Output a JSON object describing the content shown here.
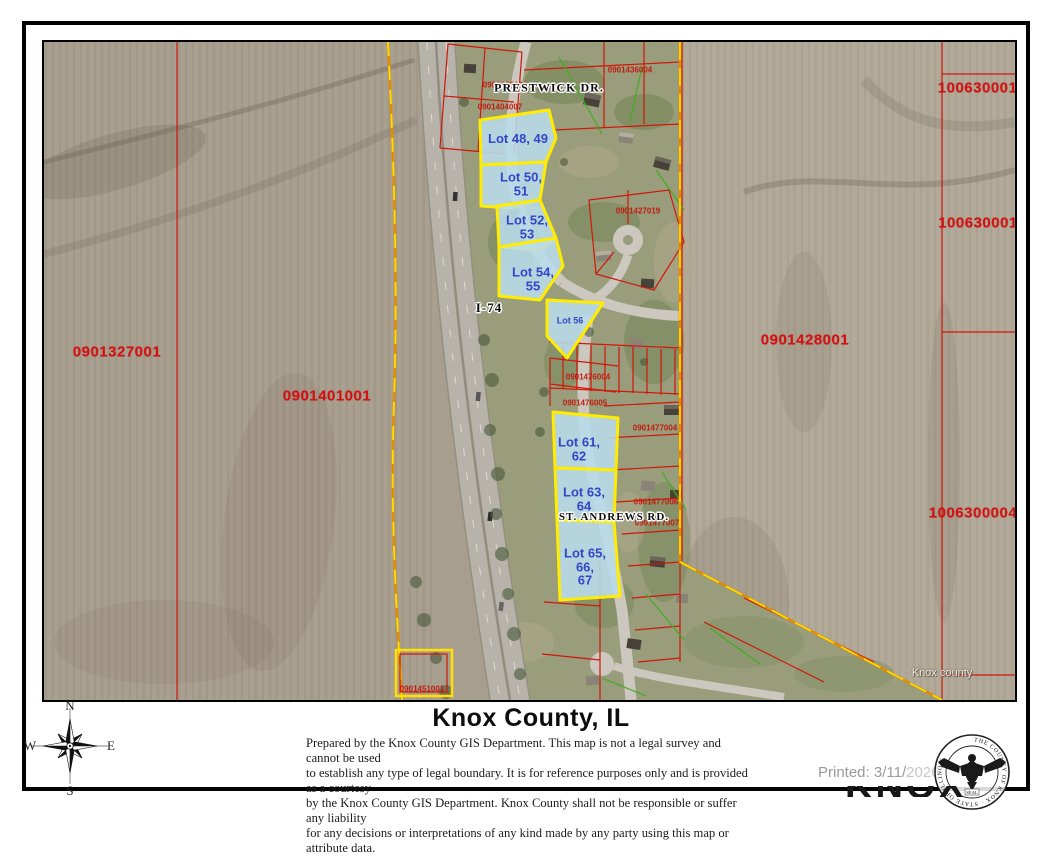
{
  "page": {
    "title": "Knox County, IL",
    "disclaimer_lines": [
      "Prepared by the Knox County GIS Department. This map is not a legal survey and cannot be used",
      "to establish any type of legal boundary. It is for reference purposes only and is provided as a courtesy",
      "by the Knox County GIS Department.  Knox County shall not be responsible or suffer any liability",
      "for any decisions or interpretations of any kind made by any party using this map or attribute data."
    ],
    "printed_prefix": "Printed: 3/11/",
    "printed_year": "2026",
    "watermark": "Knox county",
    "clipped_footer_text": "KNOX CO"
  },
  "compass": {
    "north": "N",
    "east": "E",
    "south": "S",
    "west": "W"
  },
  "seal": {
    "ring_text": "THE COUNTY OF KNOX · STATE OF ILLINOIS",
    "center_text": "SEAL"
  },
  "map": {
    "street_labels": [
      {
        "text": "PRESTWICK DR.",
        "x": 505,
        "y": 46,
        "rot": 66,
        "size": 12
      },
      {
        "text": "ST. ANDREWS RD.",
        "x": 570,
        "y": 475,
        "rot": 87,
        "size": 11
      },
      {
        "text": "I-74",
        "x": 445,
        "y": 266,
        "rot": 78,
        "size": 13
      }
    ],
    "field_parcel_labels": [
      {
        "id": "0901327001",
        "x": 73,
        "y": 310,
        "rot": 0
      },
      {
        "id": "0901401001",
        "x": 283,
        "y": 354,
        "rot": 0
      },
      {
        "id": "0901428001",
        "x": 761,
        "y": 298,
        "rot": 0
      },
      {
        "id": "1006300010",
        "x": 938,
        "y": 46,
        "rot": -90
      },
      {
        "id": "1006300011",
        "x": 938,
        "y": 181,
        "rot": -90
      },
      {
        "id": "1006300004",
        "x": 929,
        "y": 471,
        "rot": -90
      }
    ],
    "small_parcel_labels": [
      {
        "id": "0901427019",
        "x": 594,
        "y": 169,
        "rot": 0
      },
      {
        "id": "0901476004",
        "x": 544,
        "y": 335,
        "rot": 14
      },
      {
        "id": "0901476005",
        "x": 541,
        "y": 361,
        "rot": 16
      },
      {
        "id": "0901477004",
        "x": 611,
        "y": 386,
        "rot": 0
      },
      {
        "id": "0901477006",
        "x": 612,
        "y": 460,
        "rot": 0
      },
      {
        "id": "0901477007",
        "x": 613,
        "y": 481,
        "rot": 0
      },
      {
        "id": "0901451001",
        "x": 378,
        "y": 647,
        "rot": 0
      },
      {
        "id": "0901403006",
        "x": 461,
        "y": 43,
        "rot": 10
      },
      {
        "id": "0901404007",
        "x": 456,
        "y": 65,
        "rot": 12
      },
      {
        "id": "0901436004",
        "x": 586,
        "y": 28,
        "rot": 0
      }
    ],
    "lot_labels": [
      {
        "lines": [
          "Lot 48, 49"
        ],
        "x": 474,
        "y": 97,
        "size": 13
      },
      {
        "lines": [
          "Lot 50,",
          "51"
        ],
        "x": 477,
        "y": 142,
        "size": 13
      },
      {
        "lines": [
          "Lot 52,",
          "53"
        ],
        "x": 483,
        "y": 185,
        "size": 13
      },
      {
        "lines": [
          "Lot 54,",
          "55"
        ],
        "x": 489,
        "y": 237,
        "size": 13
      },
      {
        "lines": [
          "Lot 56"
        ],
        "x": 526,
        "y": 279,
        "size": 9
      },
      {
        "lines": [
          "Lot 61,",
          "62"
        ],
        "x": 535,
        "y": 407,
        "size": 13
      },
      {
        "lines": [
          "Lot 63,",
          "64"
        ],
        "x": 540,
        "y": 457,
        "size": 13
      },
      {
        "lines": [
          "Lot 65,",
          "66,",
          "67"
        ],
        "x": 541,
        "y": 525,
        "size": 13
      }
    ]
  },
  "colors": {
    "parcel_red": "#d90f0f",
    "lot_fill": "#b9dcec",
    "lot_stroke": "#ffec00",
    "lot_text": "#3246c8",
    "boundary_orange": "#e28d00",
    "boundary_yellow": "#ffdf00",
    "field_tan": "#a89e8d",
    "survey_green": "#3fae1f"
  }
}
